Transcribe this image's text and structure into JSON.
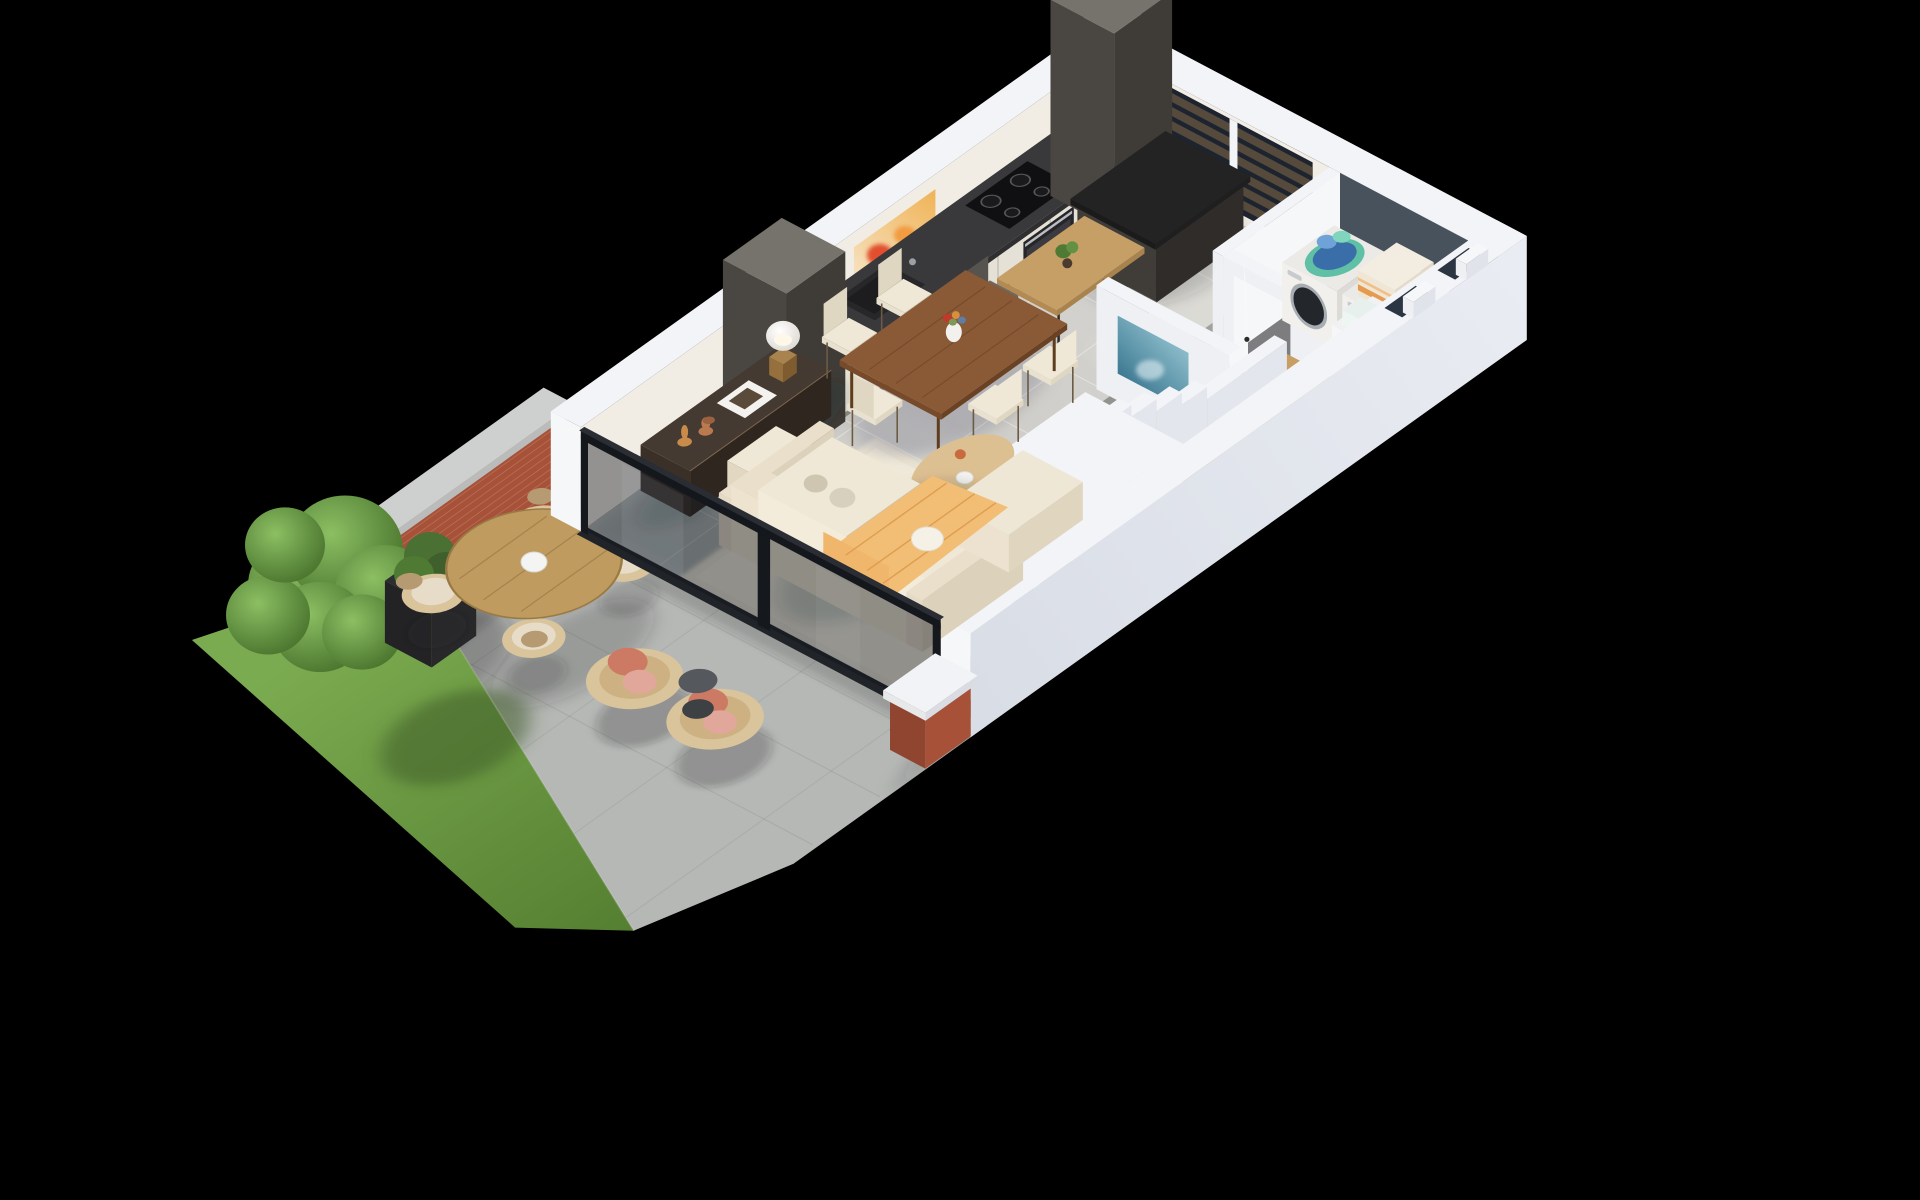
{
  "meta": {
    "kind": "3d-floorplan-render",
    "view": "isometric-dollhouse",
    "background": "black",
    "floor": "ground floor apartment with rear terrace and garden"
  },
  "scene": {
    "rooms": [
      {
        "name": "kitchen",
        "furniture": [
          "white-cabinet-run",
          "dark-worktop",
          "cooktop-4-burners",
          "oven",
          "sink",
          "tall-dark-cabinet-north",
          "tall-dark-cabinet-south",
          "charcoal-island",
          "wood-bar-table",
          "potted-plant",
          "two-grey-bar-chairs",
          "louvered-window"
        ]
      },
      {
        "name": "dining-area",
        "furniture": [
          "walnut-dining-table",
          "five-cream-chairs",
          "flower-vase",
          "dark-sideboard",
          "copper-vases",
          "ochre-vase",
          "magazine",
          "table-lamp",
          "orange-abstract-painting"
        ]
      },
      {
        "name": "living-area",
        "furniture": [
          "cream-sofa",
          "chaise",
          "ottoman",
          "orange-throw",
          "white-pillow",
          "grey-pillows",
          "cream-shag-rug",
          "oval-wood-coffee-table",
          "white-bowl",
          "orange-vase"
        ]
      },
      {
        "name": "hallway",
        "furniture": [
          "blue-abstract-painting",
          "dark-grey-tiles",
          "open-entry-door"
        ]
      },
      {
        "name": "wc-understairs",
        "furniture": [
          "taupe-shelf-wall",
          "two-wood-shelves",
          "small-frames",
          "sage-glass-door"
        ]
      },
      {
        "name": "staircase",
        "furniture": [
          "wood-treads",
          "wood-landing",
          "white-stringer-wall"
        ]
      },
      {
        "name": "laundry-room",
        "furniture": [
          "washer",
          "dryer",
          "teal-laundry-basket",
          "blue-clothes",
          "striped-towel-stack",
          "white-shelf-unit",
          "slate-accent-walls"
        ]
      }
    ],
    "exterior": [
      {
        "name": "terrace",
        "furniture": [
          "concrete-pavers",
          "round-teak-table",
          "white-hex-centerpiece",
          "four-rattan-dining-chairs",
          "two-rattan-lounge-chairs",
          "coral-cushions",
          "black-side-table",
          "black-planter-with-shrub",
          "brick-garden-wall",
          "concrete-wall-cap",
          "brick-pier-with-cap",
          "glass-sliding-wall"
        ]
      },
      {
        "name": "garden",
        "furniture": [
          "lawn",
          "large-green-tree"
        ]
      }
    ]
  },
  "colors": {
    "bg": "#000000",
    "concrete": "#b6b8b6",
    "grassA": "#7bab50",
    "grassB": "#547e30",
    "brick": "#a75138",
    "brickDark": "#8f4530",
    "brickLight": "#b5613f",
    "cap": "#cdd0ce",
    "capSide": "#b9bcba",
    "treeHi": "#8cbf63",
    "treeLo": "#45702a",
    "treeBack": "#375c24",
    "planter": "#2e2e31",
    "planterSide": "#232326",
    "shrub": "#4b7034",
    "rattan": "#d9c49c",
    "rattanInner": "#cdb183",
    "rattanRim": "#b69a72",
    "coral": "#cd7a64",
    "blush": "#e0a79a",
    "floor": "#c6c5c1",
    "floorLight": "#d8d7d3",
    "floorDark": "#8e8e8b",
    "grout": "#efeee9",
    "laundryFloor": "#7d7d80",
    "rug": "#e9e3d4",
    "rugLight": "#efe9da",
    "wallTop": "#f3f4f8",
    "wallFront": "#eef0f4",
    "wallSide": "#f6f7f9",
    "wallOuter": "#e9ecf2",
    "wallOuterDark": "#d9dde6",
    "innerWarm": "#f2eee6",
    "innerWarmW": "#f1ede4",
    "laundrySlate": "#47525d",
    "cabinetWhite": "#efeae0",
    "cabinetWhiteSide": "#e6e1d6",
    "cabinetWhiteTop": "#e2ddd2",
    "counterTop": "#39393b",
    "counterSide": "#2f2f31",
    "cabinetDark": "#4a4641",
    "cabinetDarkSide": "#3f3b37",
    "cabinetDarkTop": "#76726c",
    "island": "#403d39",
    "islandSide": "#2f2c29",
    "islandTop": "#232324",
    "woodBar": "#c59f66",
    "woodBarSide": "#a8834e",
    "woodTable": "#8a5a36",
    "woodTableSide": "#774a2a",
    "woodTableDark": "#6b4124",
    "woodStair": "#c79e63",
    "stairRiser": "#b08953",
    "stairSide": "#9e7a48",
    "woodShelf": "#c9a470",
    "woodShelfSide": "#aa8756",
    "woodCoffee": "#ddc092",
    "woodCoffeeDark": "#bb9d6b",
    "woodRound": "#bf9b60",
    "sideboard": "#3a3027",
    "sideboardTop": "#453a31",
    "sideboardSide": "#2f2620",
    "sofa": "#f0e8d6",
    "sofaBack": "#e9dfca",
    "sofaShade": "#e0d5bf",
    "throw": "#f2bd74",
    "throwFold": "#dd9e52",
    "pillowWhite": "#f6f1e6",
    "pillowGrey": "#d8d0bf",
    "chairCream": "#efe8d7",
    "chairCreamDark": "#e0d7c2",
    "chairGrey": "#6d6862",
    "chairGreyDark": "#57534e",
    "frameBronze": "#8a6f4e",
    "taupe": "#b3a091",
    "taupeDark": "#a08d7c",
    "sageA": "#b0b49e",
    "sageB": "#878d74",
    "applianceFront": "#f2f0ec",
    "applianceSide": "#dddbd6",
    "applianceTop": "#eceae6",
    "drum": "#23262b",
    "drumRing": "#a7adb2",
    "basketTeal": "#5fc0a6",
    "clothesBlue": "#3a6ea8",
    "clothesLight": "#6fa3d8",
    "towel": "#f3ede1",
    "towelStripe": "#e69a4e",
    "glassTint": "rgba(16,22,30,0.42)",
    "frameDark": "#15181c",
    "track": "#202327",
    "windowSlot": "#1d2430",
    "slat": "#554a3b",
    "ventSlot": "#2c3542",
    "artOliteA": "#f7ead2",
    "artOliteB": "#f0b357",
    "artOred": "#e2502e",
    "artOorange": "#f29b3f",
    "artOyellow": "#f5c96b",
    "artOdeep": "#c4302e",
    "artBdeep": "#2e6d88",
    "artBlite": "#a8d4de",
    "copper": "#b97a4f",
    "copperDark": "#9c6240",
    "ochre": "#c98b4a",
    "paper": "#f4f2ee",
    "shadow": "rgba(25,28,32,0.9)",
    "sun": "rgba(255,252,240,0.9)"
  }
}
